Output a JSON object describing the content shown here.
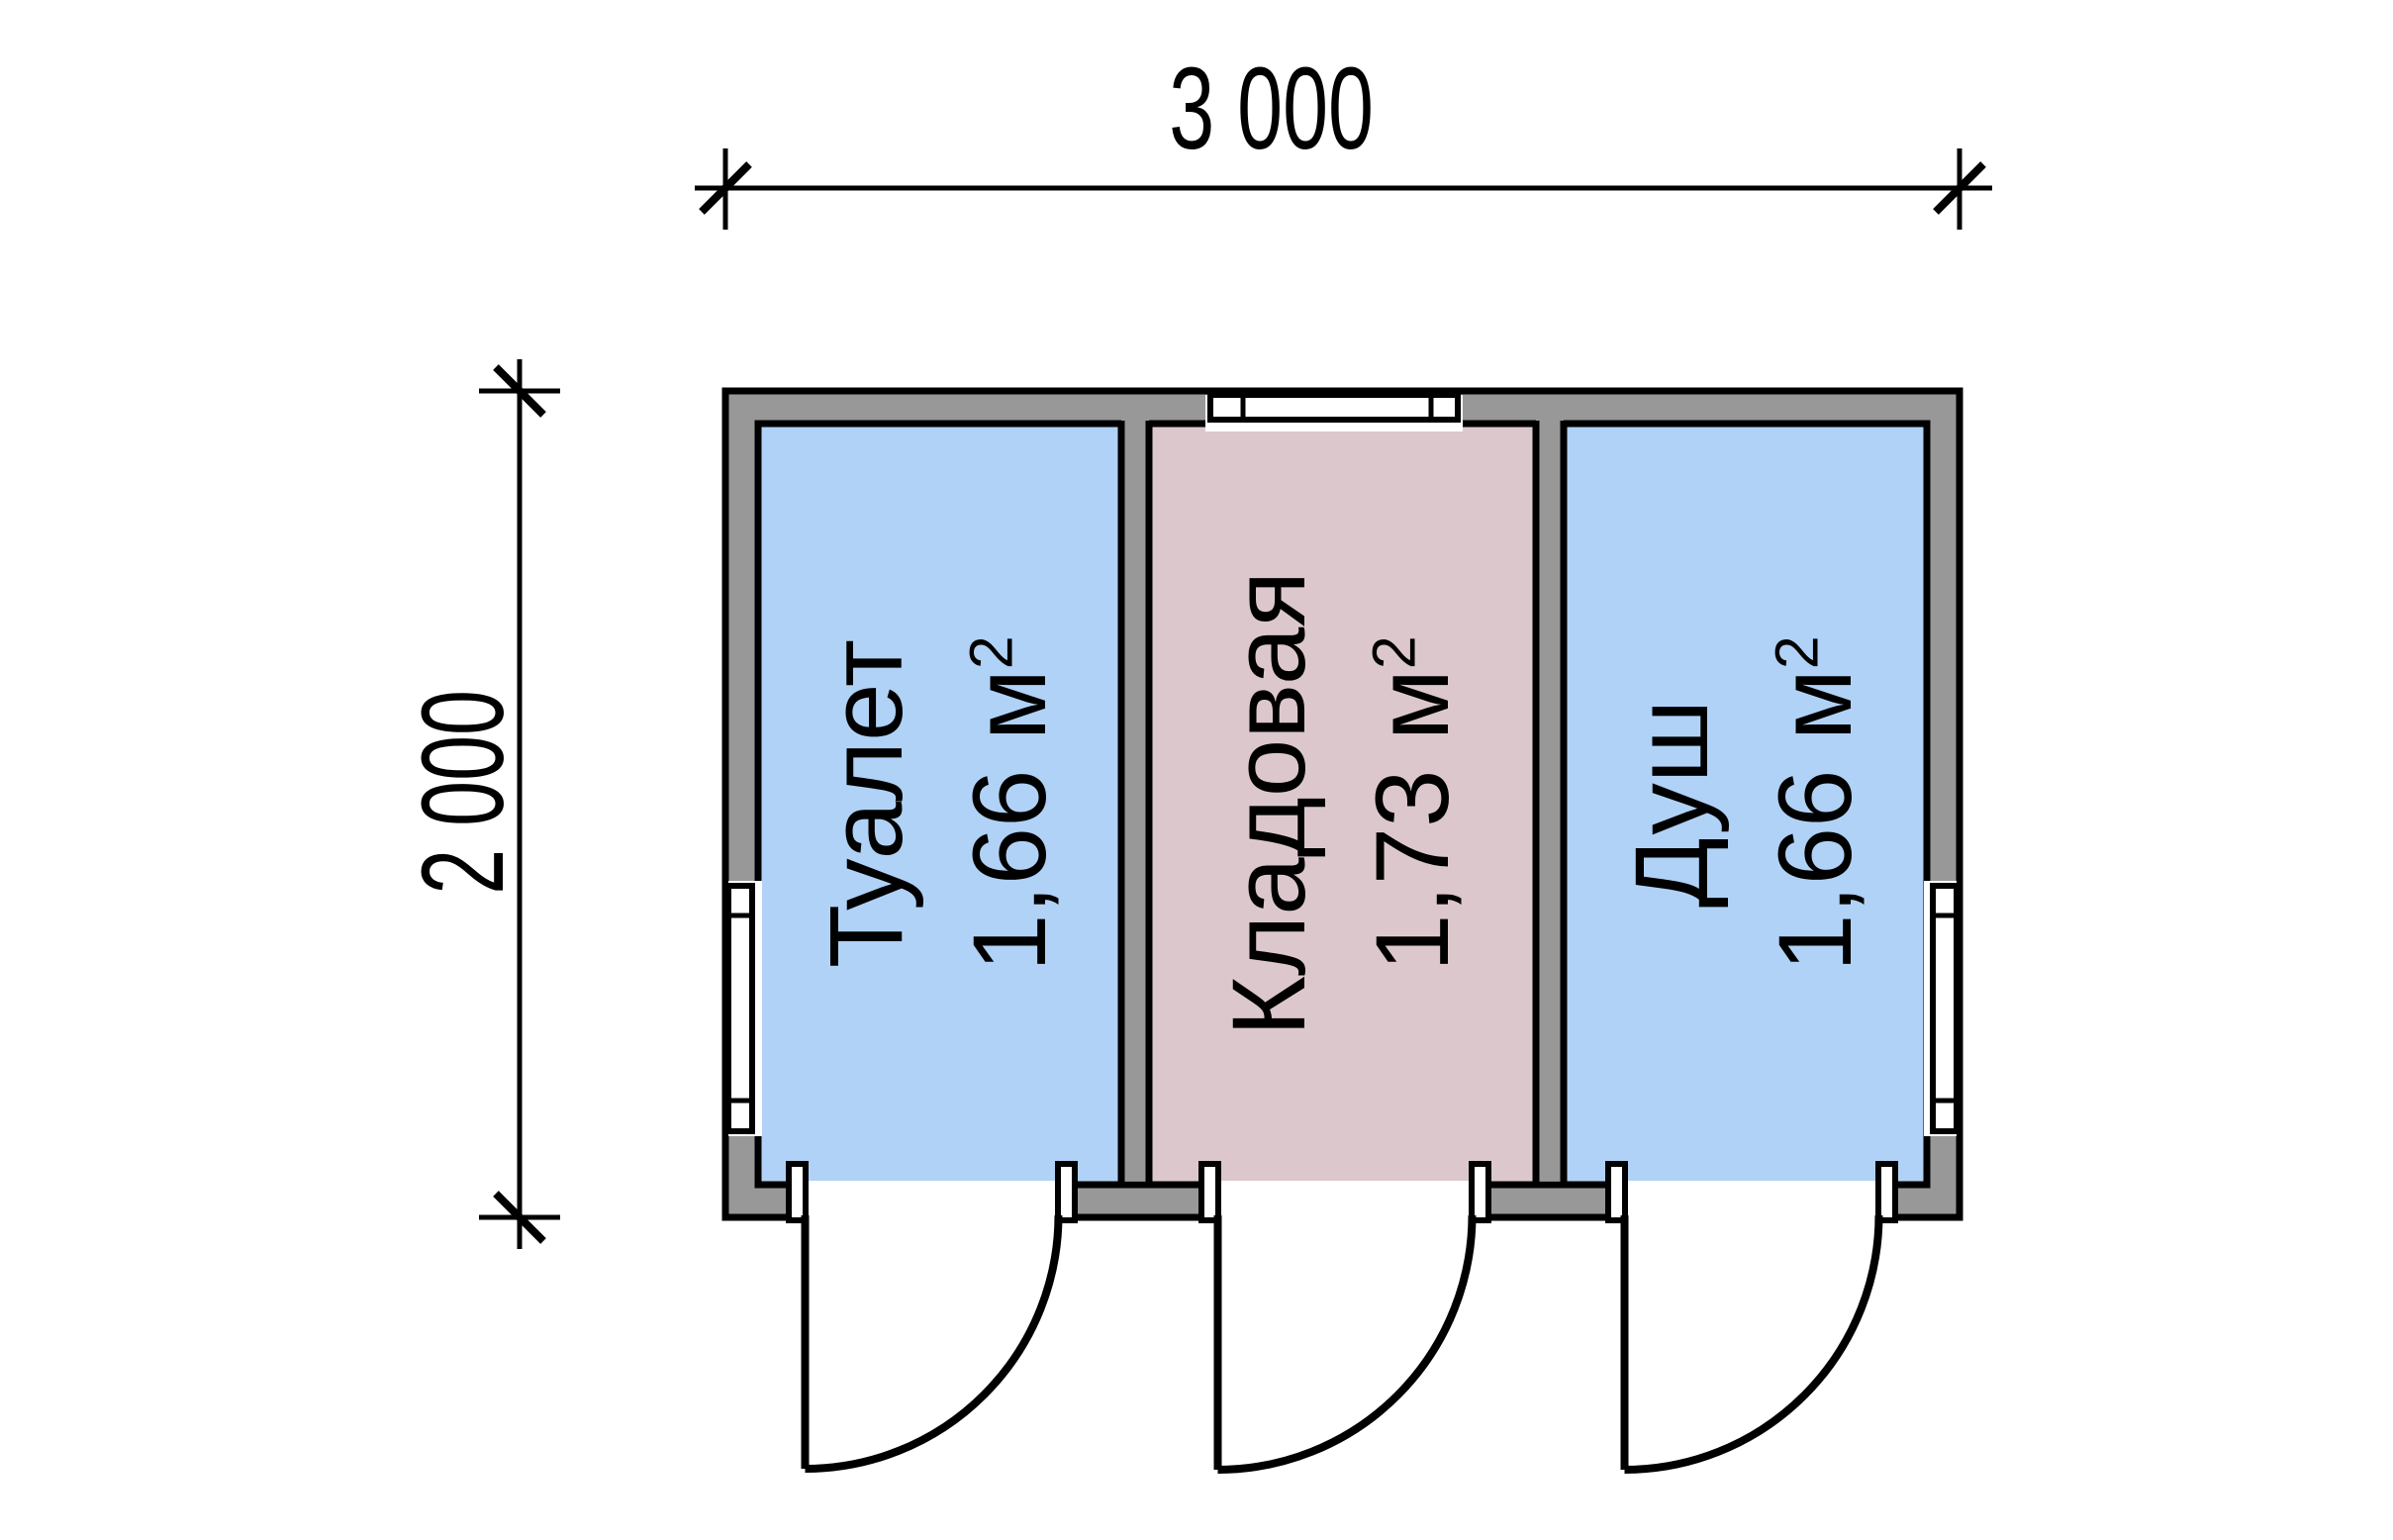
{
  "dimensions": {
    "width": {
      "label": "3 000"
    },
    "height": {
      "label": "2 000"
    }
  },
  "rooms": [
    {
      "name": "Туалет",
      "area_value": "1,66 м",
      "area_sup": "2",
      "fill": "#b0d2f6"
    },
    {
      "name": "Кладовая",
      "area_value": "1,73 м",
      "area_sup": "2",
      "fill": "#dcc8cc"
    },
    {
      "name": "Душ",
      "area_value": "1,66 м",
      "area_sup": "2",
      "fill": "#b0d2f6"
    }
  ],
  "colors": {
    "wall": "#989898",
    "outline": "#000000",
    "room_blue": "#b0d2f6",
    "room_pink": "#dcc8cc",
    "background": "#ffffff",
    "opening": "#ffffff"
  }
}
